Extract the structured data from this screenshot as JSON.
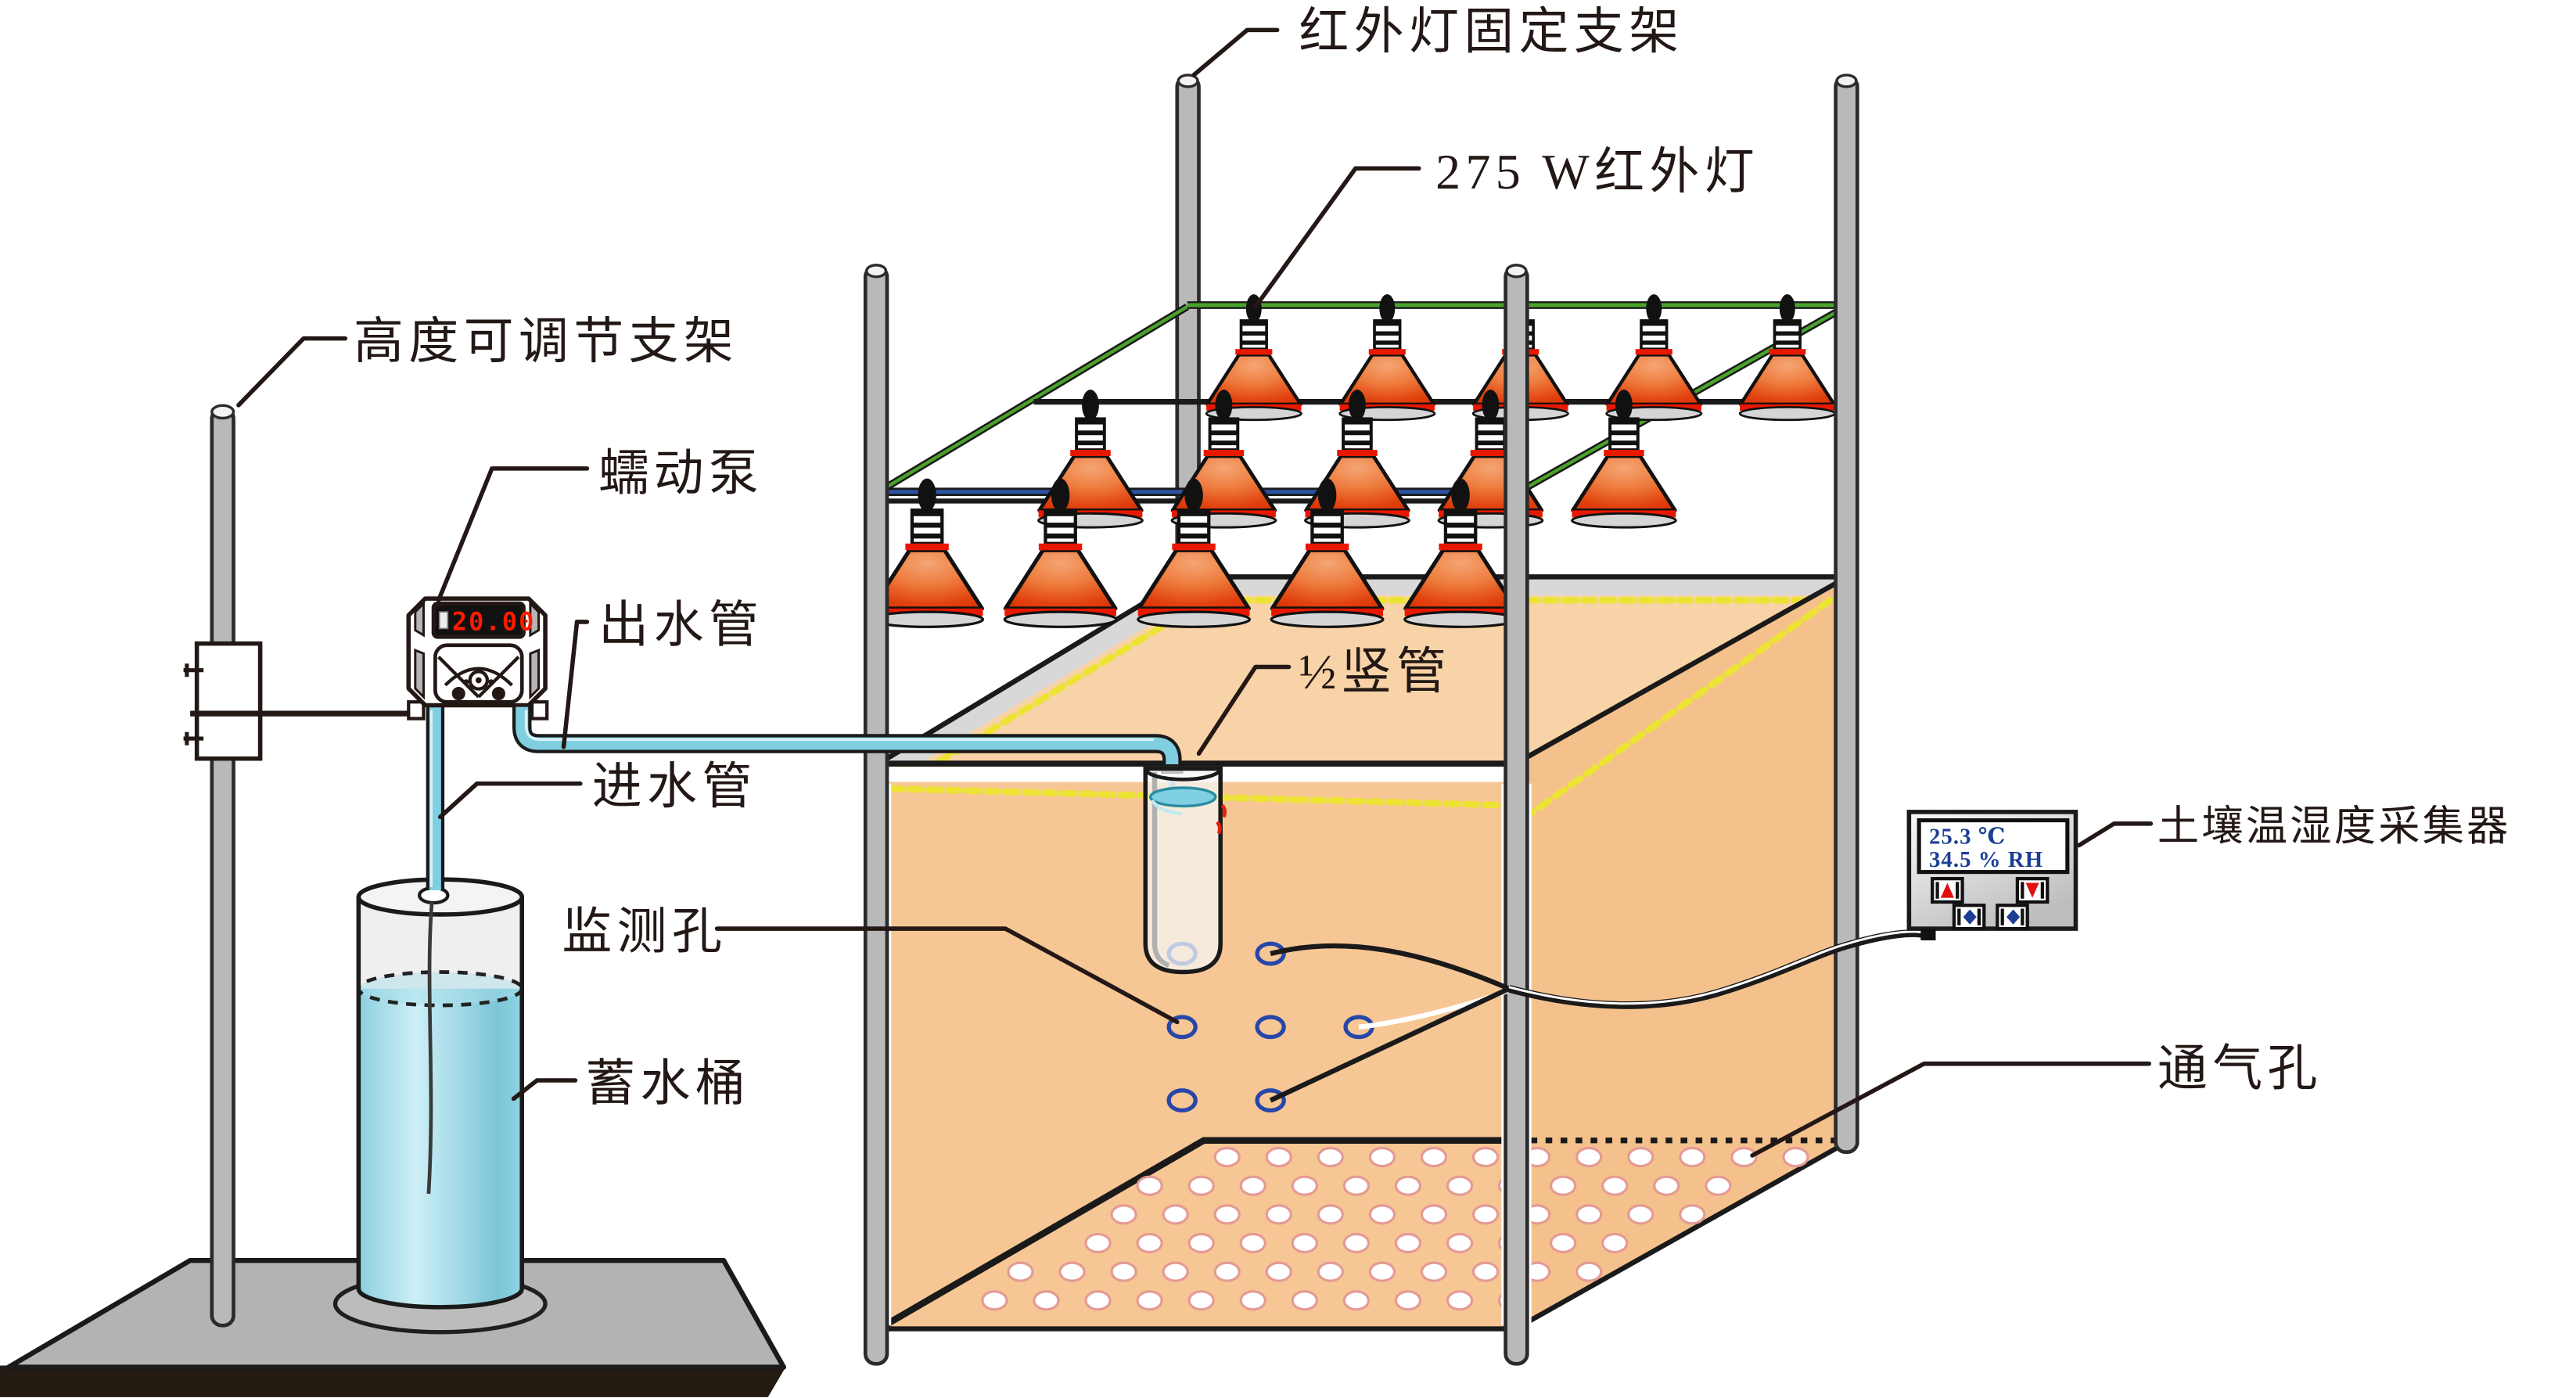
{
  "diagram": {
    "labels": {
      "lamp_bracket": "红外灯固定支架",
      "infrared_lamp": "275 W红外灯",
      "adjustable_stand": "高度可调节支架",
      "peristaltic_pump": "蠕动泵",
      "outlet_pipe": "出水管",
      "inlet_pipe": "进水管",
      "standpipe": "½竖管",
      "monitoring_holes": "监测孔",
      "water_bucket": "蓄水桶",
      "soil_sensor": "土壤温湿度采集器",
      "vent_holes": "通气孔"
    },
    "pump_display_value": "20.00",
    "sensor_display": {
      "temperature": "25.3 ℃",
      "humidity": "34.5 % RH"
    },
    "counts": {
      "lamp_rows": 3,
      "lamps_per_row": 5,
      "monitoring_holes": 7
    },
    "colors": {
      "soil": "#f6c695",
      "soil_top": "#f8d3a8",
      "soil_right": "#f4c18c",
      "lamp_red_dark": "#d62a02",
      "lamp_red_light": "#f5a575",
      "lamp_ring": "#e81800",
      "water": "#8ed5e4",
      "water_light": "#cdeff6",
      "tube": "#7fcfe0",
      "frame_green": "#4aa32a",
      "frame_blue": "#2a52a0",
      "marker_yellow": "#ece335",
      "hole_blue": "#2747a8",
      "vent_ring": "#e59a94",
      "pole_gray": "#b9b9b9",
      "band_gray": "#d8d8d8",
      "digit_red": "#ff1a00",
      "display_blue": "#1c3f94"
    }
  }
}
